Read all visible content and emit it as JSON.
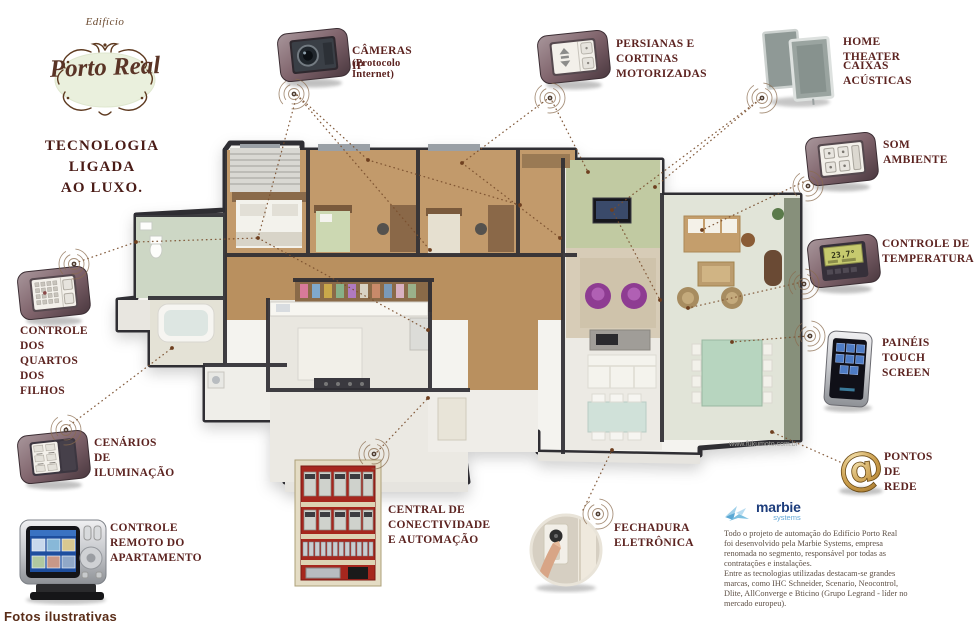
{
  "branding": {
    "edificio": "Edifício",
    "name": "Porto Real",
    "tagline_line1": "TECNOLOGIA LIGADA",
    "tagline_line2": "AO LUXO."
  },
  "callouts": {
    "cameras": {
      "icon": "ip-camera-wall-plate-icon",
      "label": "CÂMERAS IP",
      "sublabel": "(Protocolo Internet)"
    },
    "persianas": {
      "icon": "blinds-switch-wall-plate-icon",
      "label": "PERSIANAS E\nCORTINAS\nMOTORIZADAS"
    },
    "home_theater": {
      "icon": "speaker-panels-icon",
      "label": "HOME THEATER",
      "label2": "CAIXAS ACÚSTICAS"
    },
    "som_ambiente": {
      "icon": "audio-keypad-wall-plate-icon",
      "label": "SOM AMBIENTE"
    },
    "temperatura": {
      "icon": "thermostat-wall-plate-icon",
      "label": "CONTROLE DE\nTEMPERATURA",
      "display_value": "23,7°"
    },
    "touch_screen": {
      "icon": "touch-panel-icon",
      "label": "PAINÉIS TOUCH\nSCREEN"
    },
    "pontos_rede": {
      "icon": "gold-at-sign-icon",
      "label": "PONTOS\nDE REDE"
    },
    "fechadura": {
      "icon": "electronic-lock-photo-icon",
      "label": "FECHADURA\nELETRÔNICA"
    },
    "central": {
      "icon": "automation-cabinet-icon",
      "label": "CENTRAL DE\nCONECTIVIDADE\nE AUTOMAÇÃO"
    },
    "cenarios": {
      "icon": "lighting-keypad-wall-plate-icon",
      "label": "CENÁRIOS DE\nILUMINAÇÃO"
    },
    "remoto": {
      "icon": "touchscreen-remote-icon",
      "label": "CONTROLE\nREMOTO DO\nAPARTAMENTO"
    },
    "quartos": {
      "icon": "kids-room-keypad-wall-plate-icon",
      "label": "CONTROLE\nDOS QUARTOS\nDOS FILHOS"
    }
  },
  "floorplan": {
    "watermark": "www.fukumoto.com.br"
  },
  "marbie": {
    "name": "marbie",
    "subname": "systems",
    "paragraph1": "Todo o projeto de automação do Edifício Porto Real\nfoi desenvolvido pela Marbie Systems, empresa\nrenomada no segmento, responsável por todas as\ncontratações e instalações.",
    "paragraph2": "Entre as tecnologias utilizadas destacam-se grandes\nmarcas, como IHC Schneider, Scenario, Neocontrol,\nDlite, AllConverge e Bticino (Grupo Legrand - líder no\nmercado europeu)."
  },
  "footer": {
    "note": "Fotos ilustrativas"
  },
  "colors": {
    "accent_text": "#5c2320",
    "marbie_dark": "#1d3d7c",
    "marbie_light": "#63a8d8",
    "connector_line": "#7a4f2e"
  }
}
